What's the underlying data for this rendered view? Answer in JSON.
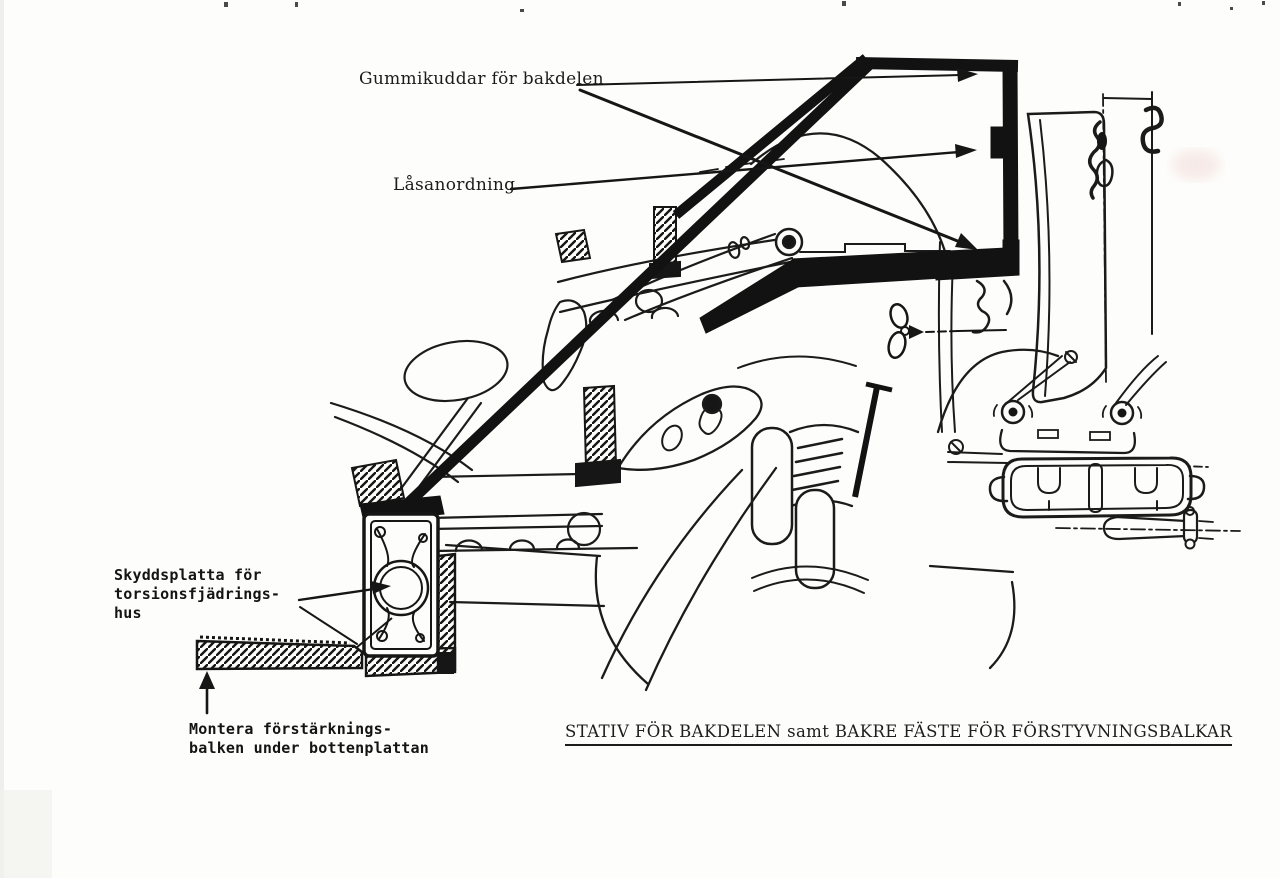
{
  "page": {
    "background": "#fdfdfb",
    "ink_color": "#161616",
    "type": "scanned workshop manual diagram"
  },
  "labels": {
    "gummikuddar": "Gummikuddar för bakdelen",
    "lasanordning": "Låsanordning",
    "skyddsplatta_line1": "Skyddsplatta för",
    "skyddsplatta_line2": "torsionsfjädrings-",
    "skyddsplatta_line3": "hus",
    "montera_line1": "Montera förstärknings-",
    "montera_line2": "balken under bottenplattan"
  },
  "caption": {
    "text": "STATIV FÖR BAKDELEN samt BAKRE FÄSTE FÖR FÖRSTYVNINGSBALKAR"
  }
}
